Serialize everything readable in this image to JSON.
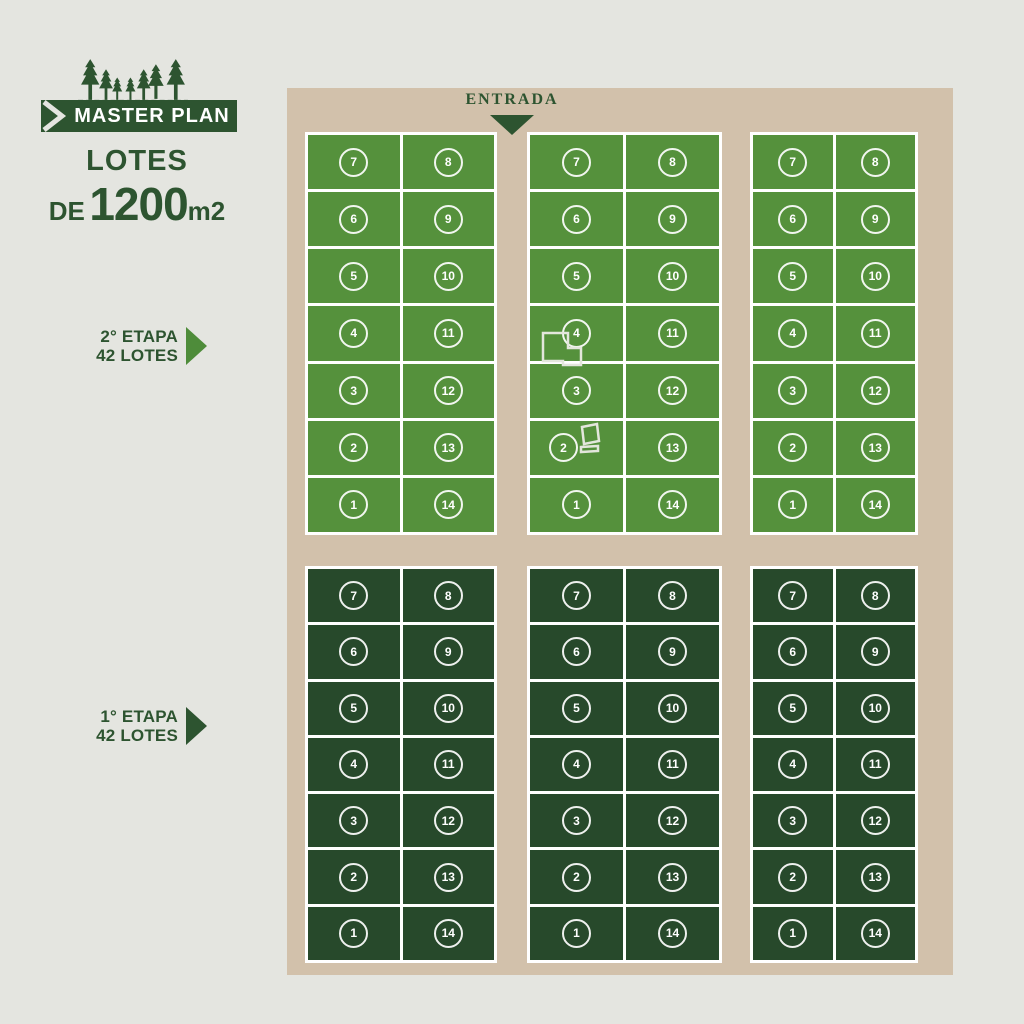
{
  "header": {
    "banner_label": "MASTER PLAN",
    "lotes_word": "LOTES",
    "de_word": "DE",
    "size_number": "1200",
    "size_unit": "m2"
  },
  "entrance": {
    "label": "ENTRADA"
  },
  "stage_labels": [
    {
      "name": "2° ETAPA",
      "lots": "42 LOTES"
    },
    {
      "name": "1° ETAPA",
      "lots": "42 LOTES"
    }
  ],
  "map": {
    "stages": [
      {
        "stage": "2° ETAPA",
        "lot_color": "#55913C",
        "blocks": [
          {
            "position": "top-left",
            "left_column": [
              "7",
              "6",
              "5",
              "4",
              "3",
              "2",
              "1"
            ],
            "right_column": [
              "8",
              "9",
              "10",
              "11",
              "12",
              "13",
              "14"
            ]
          },
          {
            "position": "top-middle",
            "left_column": [
              "7",
              "6",
              "5",
              "4",
              "3",
              "2",
              "1"
            ],
            "right_column": [
              "8",
              "9",
              "10",
              "11",
              "12",
              "13",
              "14"
            ],
            "structures": [
              "building-outline-l-shape",
              "building-outline-rectangle",
              "building-outline-bar"
            ]
          },
          {
            "position": "top-right",
            "left_column": [
              "7",
              "6",
              "5",
              "4",
              "3",
              "2",
              "1"
            ],
            "right_column": [
              "8",
              "9",
              "10",
              "11",
              "12",
              "13",
              "14"
            ]
          }
        ]
      },
      {
        "stage": "1° ETAPA",
        "lot_color": "#27492B",
        "blocks": [
          {
            "position": "bottom-left",
            "left_column": [
              "7",
              "6",
              "5",
              "4",
              "3",
              "2",
              "1"
            ],
            "right_column": [
              "8",
              "9",
              "10",
              "11",
              "12",
              "13",
              "14"
            ]
          },
          {
            "position": "bottom-middle",
            "left_column": [
              "7",
              "6",
              "5",
              "4",
              "3",
              "2",
              "1"
            ],
            "right_column": [
              "8",
              "9",
              "10",
              "11",
              "12",
              "13",
              "14"
            ]
          },
          {
            "position": "bottom-right",
            "left_column": [
              "7",
              "6",
              "5",
              "4",
              "3",
              "2",
              "1"
            ],
            "right_column": [
              "8",
              "9",
              "10",
              "11",
              "12",
              "13",
              "14"
            ]
          }
        ]
      }
    ],
    "lots_per_block": 14
  },
  "colors": {
    "background": "#E4E5E0",
    "road": "#D2C1AB",
    "stage2_green": "#55913C",
    "stage1_green": "#27492B",
    "brand_green": "#2D5430",
    "stage2_arrow": "#4E8C3A",
    "stage1_arrow": "#2D5430",
    "lot_border": "#FFFFFF",
    "lot_number_text": "#FFFFFF"
  }
}
